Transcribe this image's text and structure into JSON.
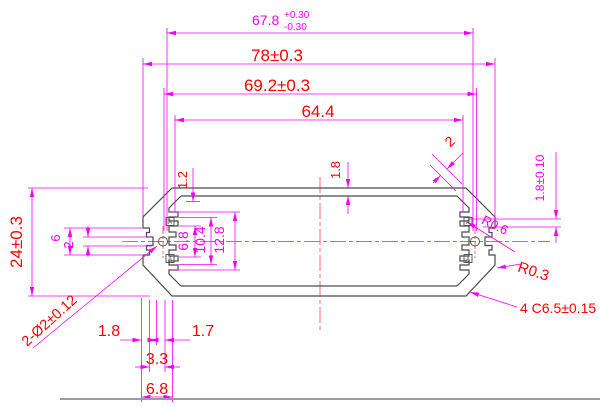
{
  "drawing": {
    "title": "extrusion-profile-cross-section",
    "colors": {
      "dimension_lines": "#F500F5",
      "dimension_text_red": "#FF0000",
      "dimension_text_magenta": "#F500F5",
      "profile_outline": "#4A4A4A",
      "centerline": "#FF5A5A",
      "border": "#9A9AA0"
    },
    "dims": {
      "width_678": {
        "value": "67.8",
        "tol_upper": "+0.30",
        "tol_lower": "-0.30"
      },
      "width_78": "78±0.3",
      "width_692": "69.2±0.3",
      "width_644": "64.4",
      "chamfer_wall_2": "2",
      "top_wall_18": "1.8",
      "left_wall_12": "1.2",
      "right_wall_18": "1.8±0.10",
      "radius_r06": "R0.6",
      "radius_r03": "R0.3",
      "chamfer_note": "4 C6.5±0.15",
      "height_24": "24±0.3",
      "groove_6": "6",
      "groove_2": "2",
      "holes_note": "2-Ø2±0.12",
      "boss_68": "6.8",
      "boss_104": "10.4",
      "boss_128": "12.8",
      "bottom_18": "1.8",
      "bottom_17": "1.7",
      "bottom_33": "3.3",
      "bottom_68": "6.8",
      "datum": "A"
    }
  }
}
